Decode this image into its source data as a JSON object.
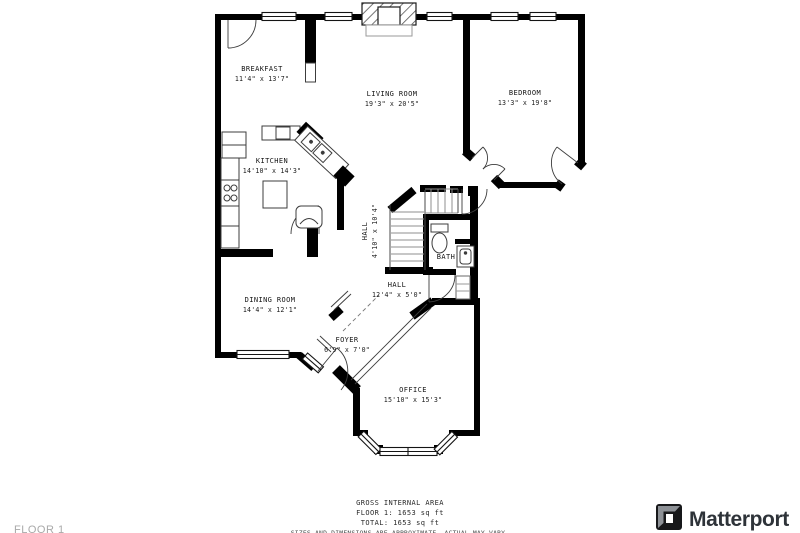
{
  "floor_plan": {
    "rooms": [
      {
        "name": "BREAKFAST",
        "dims": "11'4\" x 13'7\""
      },
      {
        "name": "LIVING ROOM",
        "dims": "19'3\" x 20'5\""
      },
      {
        "name": "BEDROOM",
        "dims": "13'3\" x 19'8\""
      },
      {
        "name": "KITCHEN",
        "dims": "14'10\" x 14'3\""
      },
      {
        "name": "HALL",
        "dims": "4'10\" x 10'4\""
      },
      {
        "name": "BATH",
        "dims": ""
      },
      {
        "name": "HALL",
        "dims": "12'4\" x 5'0\""
      },
      {
        "name": "DINING ROOM",
        "dims": "14'4\" x 12'1\""
      },
      {
        "name": "FOYER",
        "dims": "6'9\" x 7'0\""
      },
      {
        "name": "OFFICE",
        "dims": "15'10\" x 15'3\""
      }
    ],
    "footer": {
      "line1": "GROSS INTERNAL AREA",
      "line2": "FLOOR 1: 1653 sq ft",
      "line3": "TOTAL: 1653 sq ft",
      "disclaimer": "SIZES AND DIMENSIONS ARE APPROXIMATE, ACTUAL MAY VARY."
    },
    "floor_label": "FLOOR 1",
    "brand": "Matterport",
    "colors": {
      "walls": "#000000",
      "background": "#ffffff",
      "fixtures": "#3c3c3c",
      "muted_text": "#a9a9a9"
    }
  }
}
